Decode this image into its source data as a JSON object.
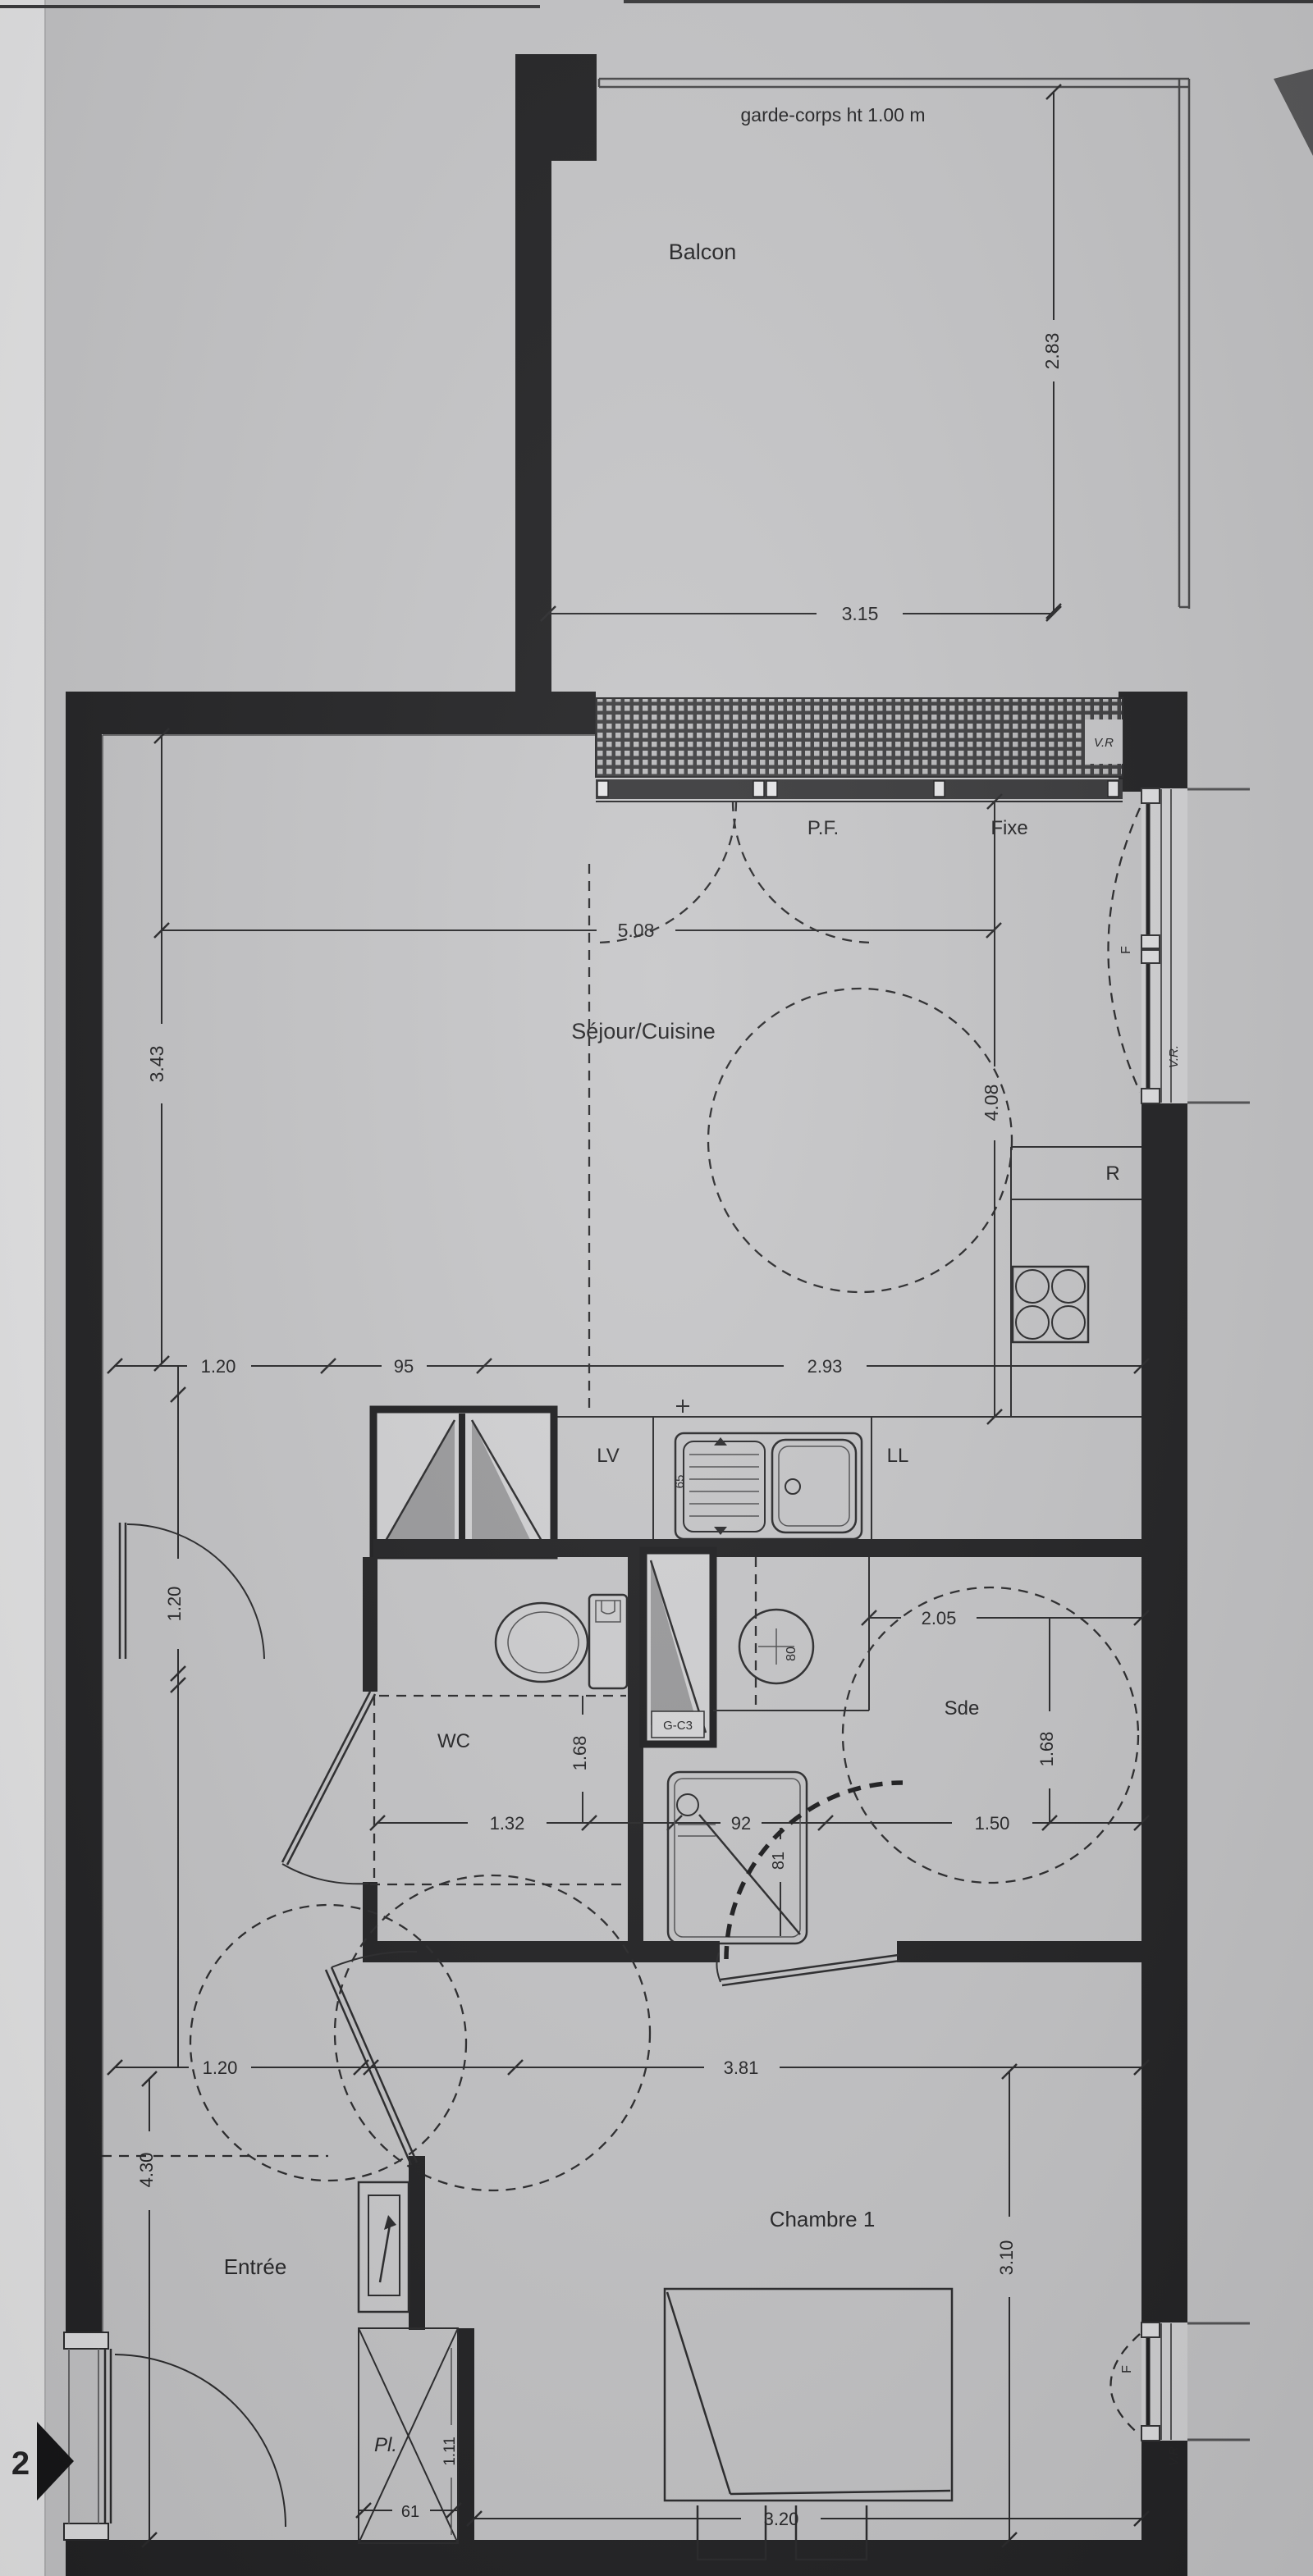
{
  "page": {
    "sheet_number": "2"
  },
  "balcony": {
    "label": "Balcon",
    "railing_note": "garde-corps ht 1.00 m",
    "dim_depth": "2.83",
    "dim_width": "3.15",
    "shutter": "V.R"
  },
  "living": {
    "label": "Séjour/Cuisine",
    "window_door": "P.F.",
    "window_fixed": "Fixe",
    "dim_width": "5.08",
    "dim_left": "3.43",
    "dim_right": "4.08",
    "window_shutter": "V.R.",
    "window_leaf": "F",
    "dim_a": "1.20",
    "dim_b": "95",
    "dim_c": "2.93"
  },
  "kitchen": {
    "fridge": "R",
    "dishwasher": "LV",
    "washer": "LL",
    "sink_depth": "65"
  },
  "wc": {
    "label": "WC",
    "dim_width": "1.32",
    "dim_depth": "1.68"
  },
  "shower_room": {
    "label": "Sde",
    "duct": "G-C3",
    "basin_dia": "80",
    "dim_width": "2.05",
    "dim_depth": "1.68",
    "dim_clear": "1.50",
    "tray_width": "92",
    "tray_depth": "81"
  },
  "corridor": {
    "dim_width": "1.20"
  },
  "hall": {
    "label": "Entrée",
    "dim_door": "1.20",
    "dim_height": "4.30"
  },
  "bedroom": {
    "label": "Chambre 1",
    "dim_width": "3.81",
    "dim_depth": "3.10",
    "dim_bed": "3.20",
    "window_shutter": "V.R.",
    "window_leaf": "F",
    "closet_label": "Pl.",
    "closet_height": "1.11",
    "closet_door": "61"
  }
}
